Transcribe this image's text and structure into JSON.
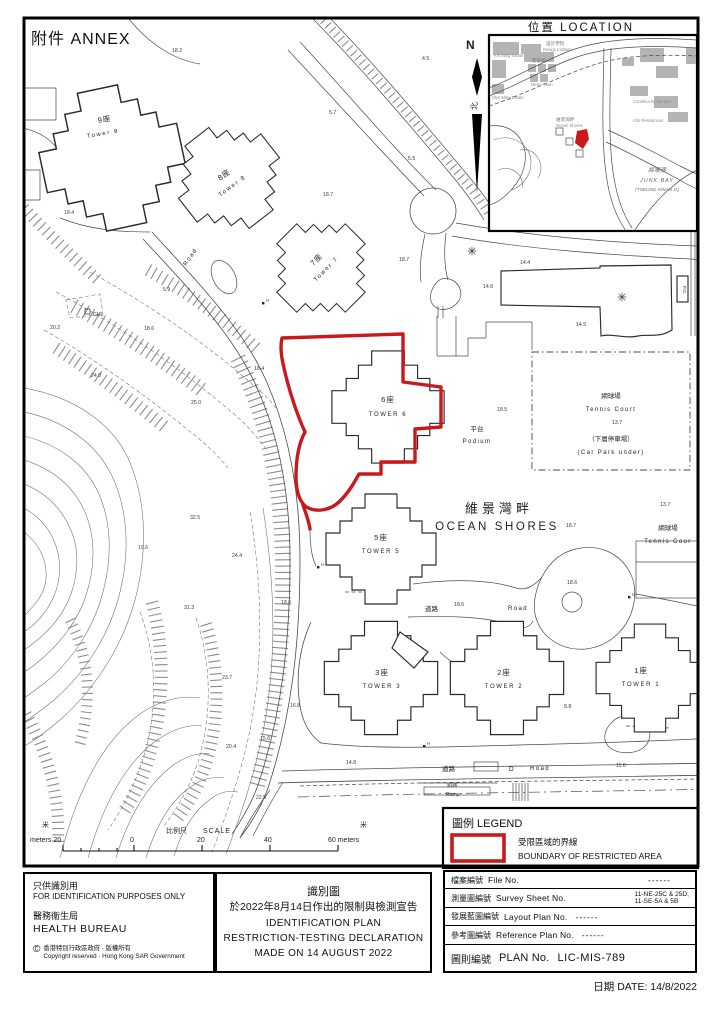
{
  "page": {
    "annex": "附件  ANNEX",
    "location_title": "位置  LOCATION",
    "north": "N",
    "north_zh": "北"
  },
  "inset": {
    "labels": {
      "kin_ming": "Kin Ming Estate",
      "design_institute_zh": "設計學院",
      "design_institute": "Design Institute",
      "metro_town_zh": "都會駅",
      "metro_town": "Metro Town",
      "shin_ming": "Shin Ming Estate",
      "ocean_shores_zh": "維景灣畔",
      "ocean_shores": "Ocean Shores",
      "corinthia": "Corinthia by the Sea",
      "alto": "Alto Residences",
      "junk_bay_zh": "將軍澳",
      "junk_bay": "JUNK BAY",
      "tseung_kwan_o": "(TSEUNG KWAN O)"
    }
  },
  "map": {
    "towers": [
      {
        "zh": "9座",
        "en": "Tower 9"
      },
      {
        "zh": "8座",
        "en": "Tower 8"
      },
      {
        "zh": "7座",
        "en": "Tower 7"
      },
      {
        "zh": "6座",
        "en": "TOWER 6"
      },
      {
        "zh": "5座",
        "en": "TOWER 5"
      },
      {
        "zh": "3座",
        "en": "TOWER 3"
      },
      {
        "zh": "2座",
        "en": "TOWER 2"
      },
      {
        "zh": "1座",
        "en": "TOWER 1"
      }
    ],
    "labels": {
      "estate_zh": "維景灣畔",
      "estate_en": "OCEAN SHORES",
      "podium_zh": "平台",
      "podium_en": "Podium",
      "tennis_zh": "網球場",
      "tennis_en": "Tennis Court",
      "carpark_zh": "（下層停車場）",
      "carpark_en": "(Car Park under)",
      "tennis2_zh": "網球場",
      "tennis2_en": "Tennis Cour",
      "road_zh": "道路",
      "road_en": "Road",
      "road2_zh": "道路",
      "road2_d": "D",
      "road2_en": "Road",
      "road3_en": "Road",
      "ramp_zh": "斜路",
      "ramp_en": "Ramp",
      "cul": "CUL",
      "po": "P.O.",
      "h": "H"
    },
    "spots": [
      "18.2",
      "4.5",
      "5.7",
      "5.5",
      "18.4",
      "18.7",
      "18.7",
      "5.9",
      "20.2",
      "18.6",
      "18.4",
      "24.0",
      "25.0",
      "14.4",
      "14.6",
      "14.5",
      "18.5",
      "13.7",
      "13.7",
      "18.7",
      "32.5",
      "24.4",
      "19.6",
      "31.3",
      "23.7",
      "20.4",
      "15.6",
      "22.5",
      "18.6",
      "16.8",
      "18.6",
      "18.6",
      "8.8",
      "14.8",
      "11.6"
    ]
  },
  "scale": {
    "unit_left": "米",
    "label_left": "meters 20",
    "zero": "0",
    "title_zh": "比例尺",
    "title_en": "SCALE",
    "t20": "20",
    "t40": "40",
    "label_right": "60 meters",
    "unit_right": "米"
  },
  "legend": {
    "title": "圖例 LEGEND",
    "item_zh": "受限區域的界線",
    "item_en": "BOUNDARY OF RESTRICTED AREA"
  },
  "footer": {
    "disclaimer_zh": "只供識別用",
    "disclaimer_en": "FOR IDENTIFICATION PURPOSES ONLY",
    "bureau_zh": "醫務衞生局",
    "bureau_en": "HEALTH BUREAU",
    "copyright_symbol": "©",
    "copyright_zh": "香港特別行政區政府 · 版權所有",
    "copyright_en": "Copyright reserved · Hong Kong SAR Government",
    "title_zh1": "識別圖",
    "title_zh2": "於2022年8月14日作出的限制與檢測宣告",
    "title_en1": "IDENTIFICATION PLAN",
    "title_en2": "RESTRICTION-TESTING DECLARATION",
    "title_en3": "MADE ON 14 AUGUST 2022",
    "table": {
      "rows": [
        {
          "zh": "檔案編號",
          "en": "File No.",
          "value": "------"
        },
        {
          "zh": "測量圖編號",
          "en": "Survey Sheet No.",
          "value": "11-NE-25C & 25D,",
          "value2": "11-SE-5A & 5B"
        },
        {
          "zh": "發展藍圖編號",
          "en": "Layout Plan No.",
          "value": "------"
        },
        {
          "zh": "參考圖編號",
          "en": "Reference Plan No.",
          "value": "------"
        },
        {
          "zh": "圖則編號",
          "en": "PLAN  No.",
          "value": "LIC-MIS-789"
        }
      ]
    },
    "date": "日期 DATE: 14/8/2022"
  },
  "colors": {
    "boundary_red": "#c8191c",
    "line_black": "#2b2b2b"
  }
}
